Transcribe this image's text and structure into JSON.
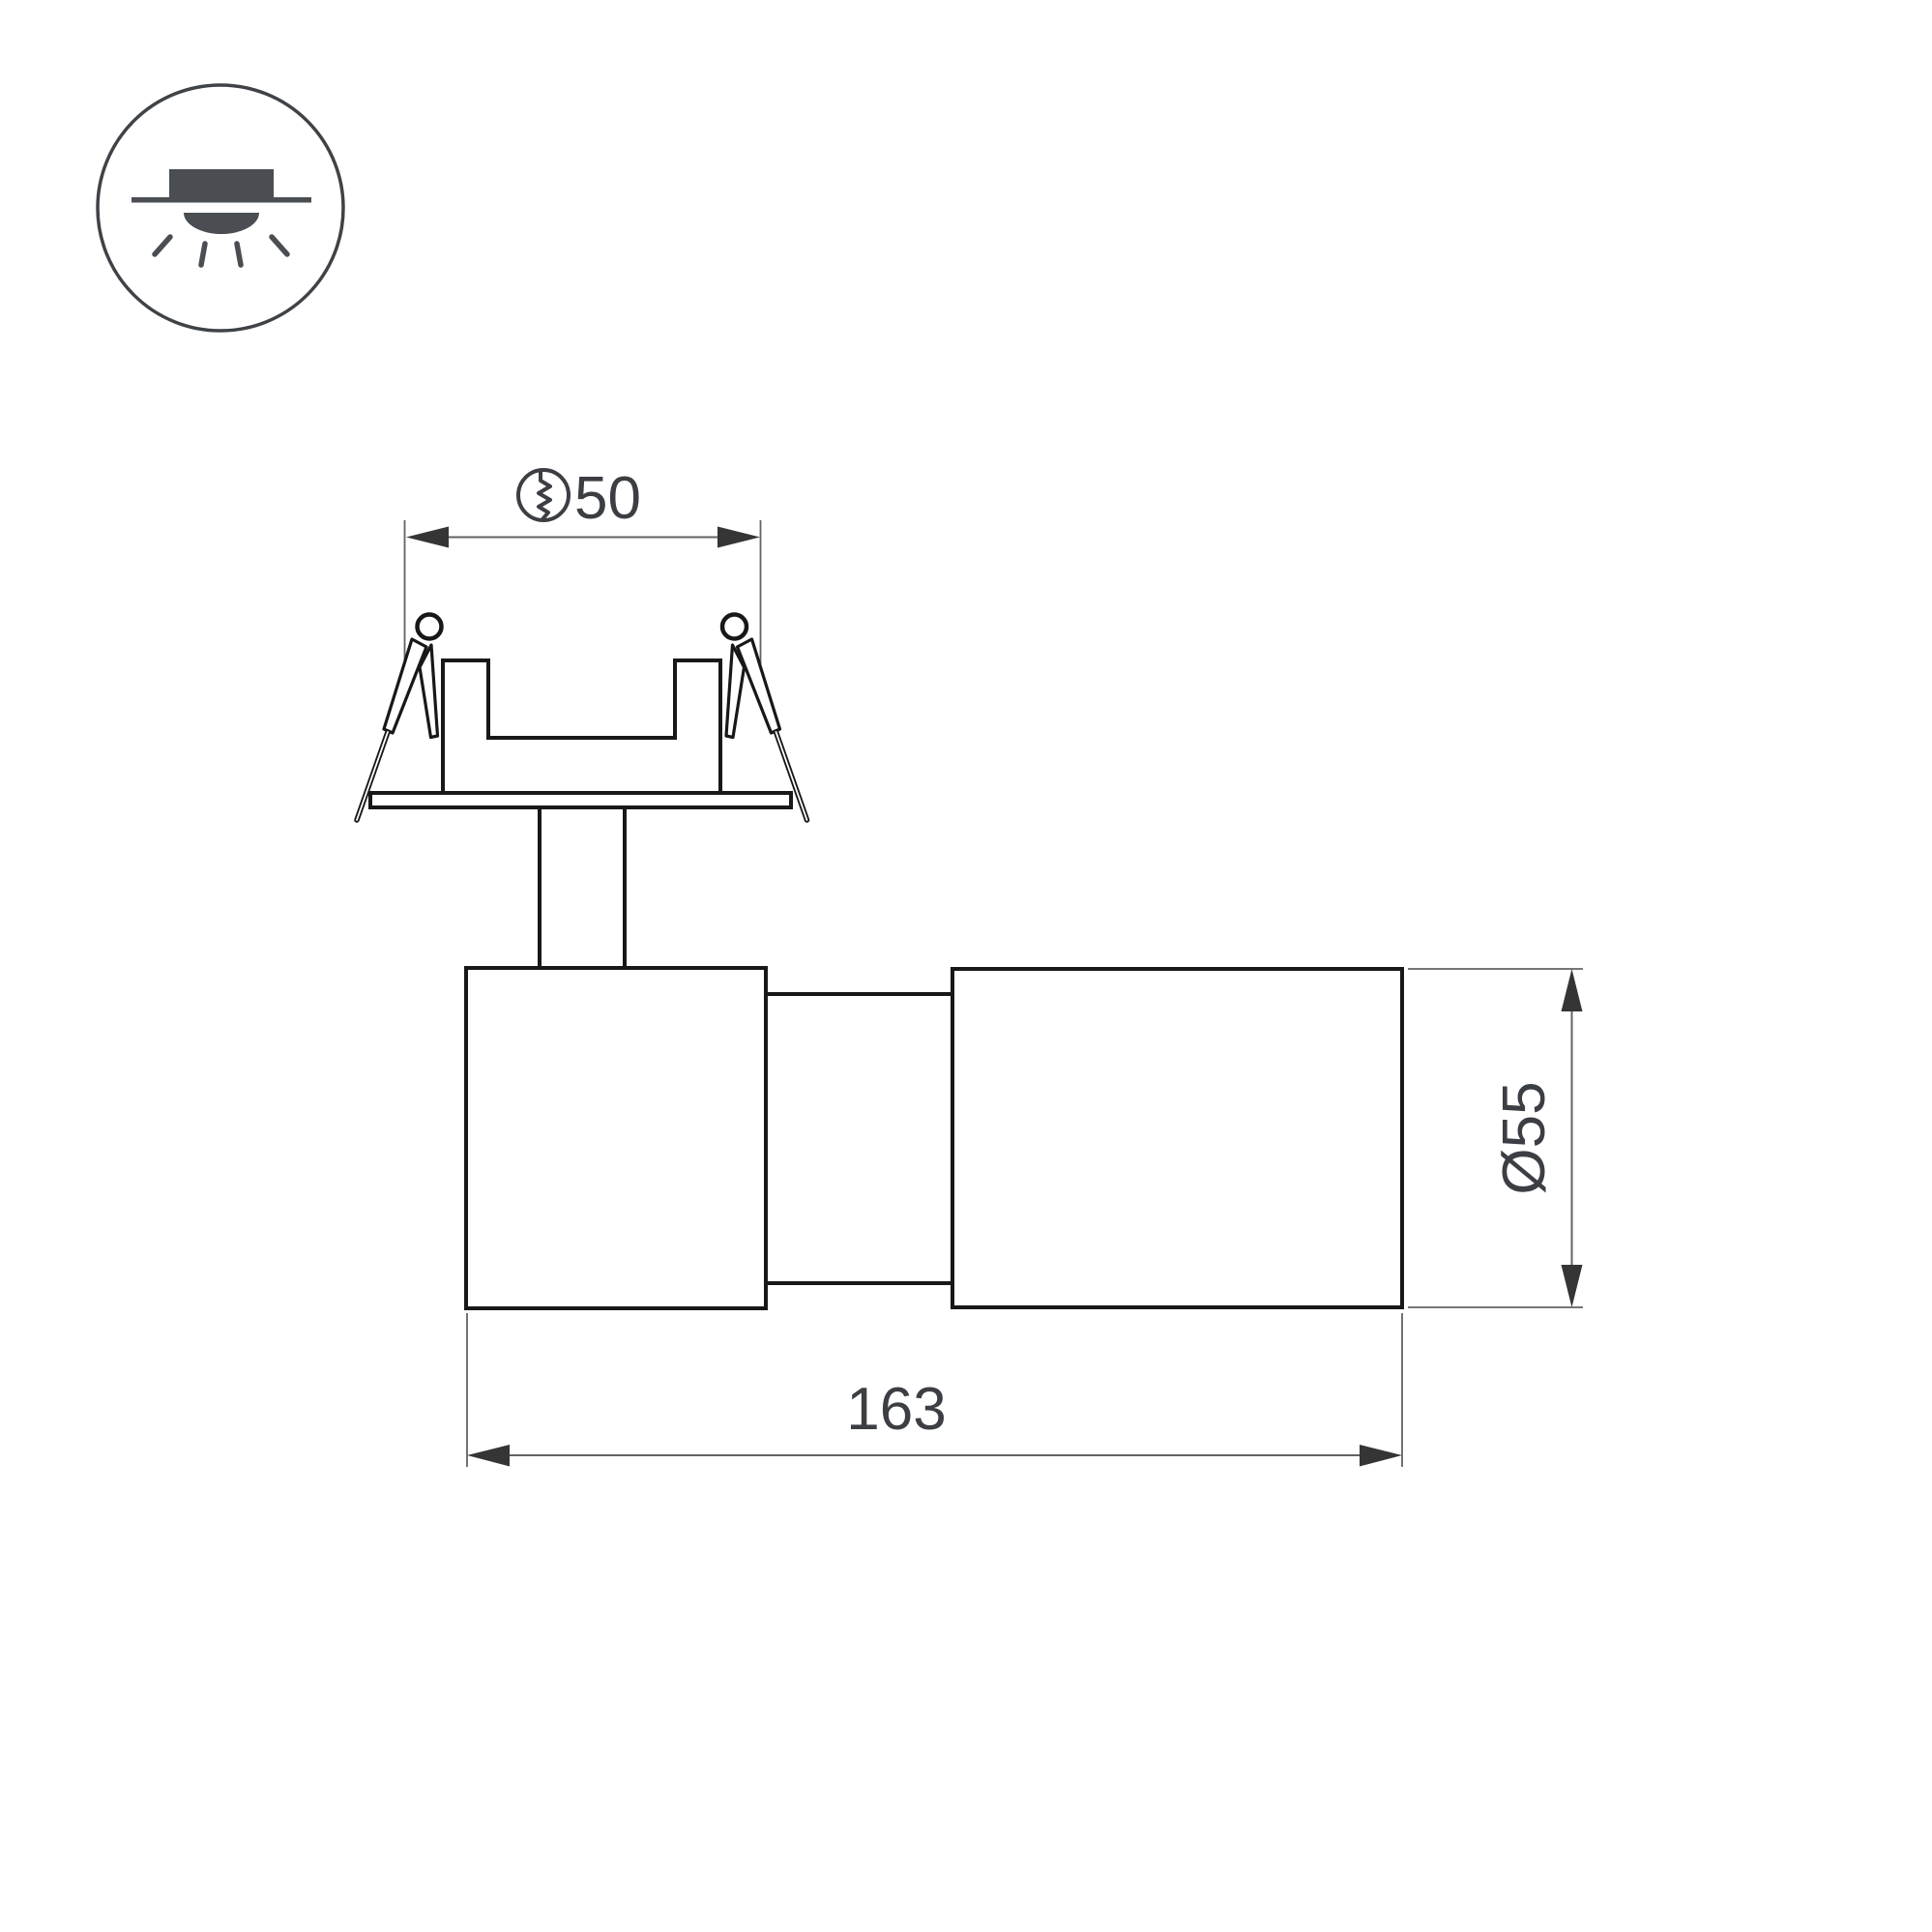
{
  "colors": {
    "background": "#ffffff",
    "outline": "#181818",
    "dimension": "#636363",
    "arrow": "#353535",
    "text": "#3b3e43",
    "icon_outline": "#3f4347",
    "icon_fill": "#4a4e52"
  },
  "product_icon": {
    "name": "recessed-downlight-icon"
  },
  "dimensions": {
    "cutout": {
      "symbol_icon": "cutout-hole-icon",
      "value": "50"
    },
    "diameter": {
      "value": "Ø55"
    },
    "length": {
      "value": "163"
    }
  }
}
